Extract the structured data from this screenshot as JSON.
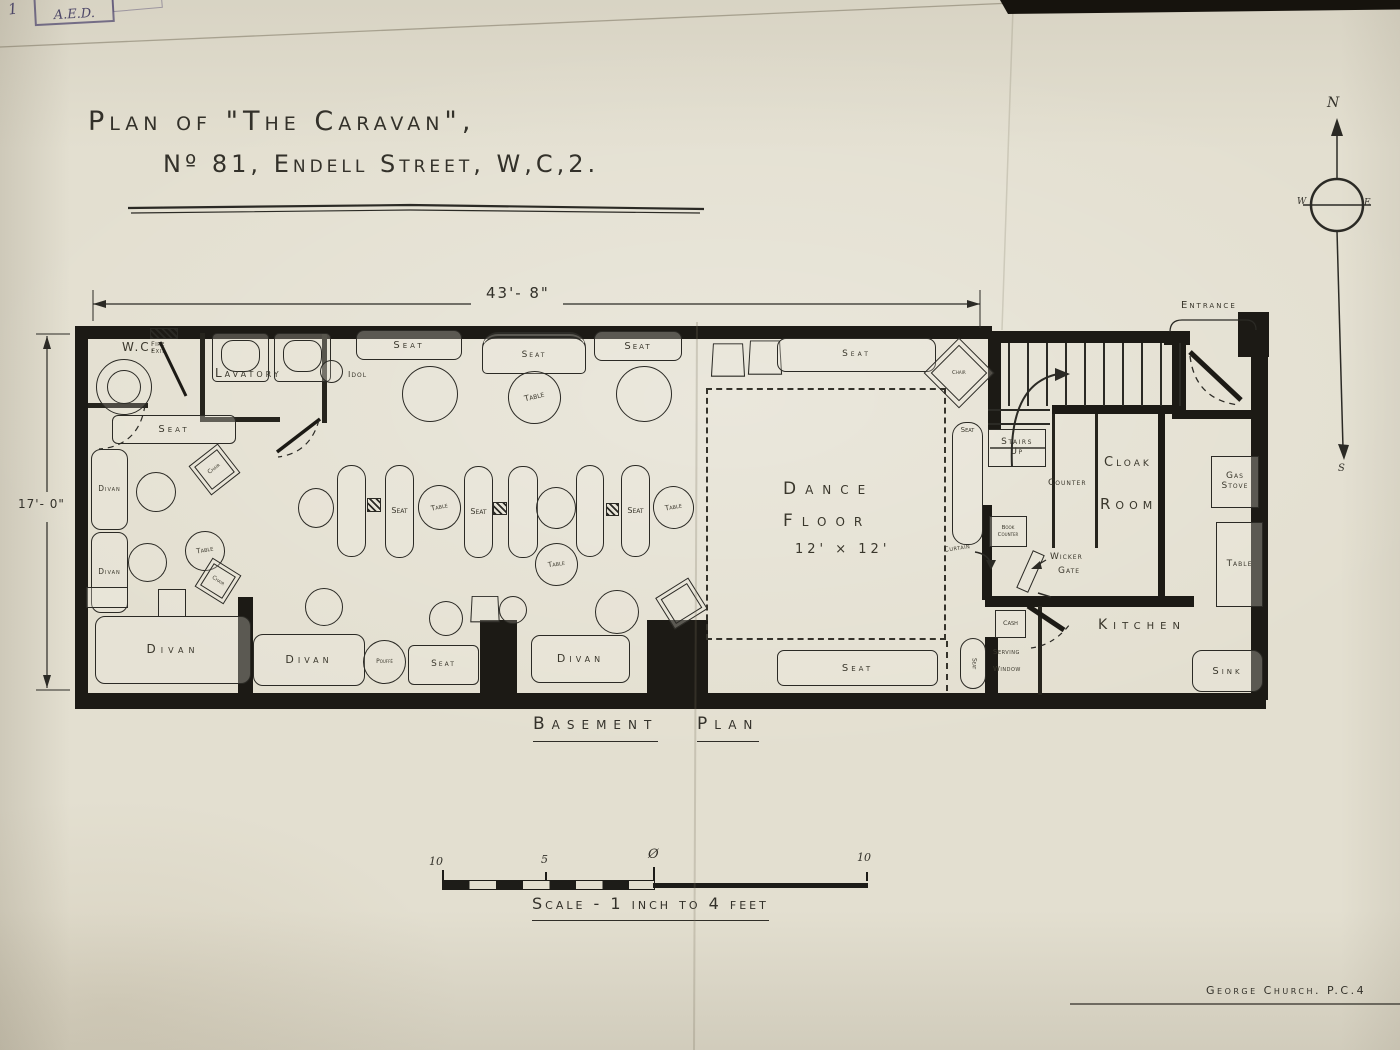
{
  "stamp": {
    "number": "1",
    "initials": "A.E.D."
  },
  "title": {
    "line1": "Plan of \"The Caravan\",",
    "line2": "Nº 81, Endell Street, W,C,2."
  },
  "compass": {
    "n": "N",
    "e": "E",
    "s": "S",
    "w": "W"
  },
  "dimensions": {
    "width": "43'- 8\"",
    "height": "17'- 0\""
  },
  "caption": {
    "word1": "Basement",
    "word2": "Plan"
  },
  "scale_bar": {
    "left_label": "10",
    "mid_label": "5",
    "zero_label": "Ø",
    "right_label": "10",
    "caption": "Scale - 1 inch to 4 feet"
  },
  "signature": "George Church. P.C.4",
  "plan": {
    "walls": [
      [
        75,
        326,
        917,
        13
      ],
      [
        988,
        331,
        200,
        12
      ],
      [
        75,
        326,
        13,
        380
      ],
      [
        75,
        693,
        1191,
        16
      ],
      [
        1251,
        340,
        17,
        360
      ],
      [
        1238,
        312,
        31,
        45
      ],
      [
        1164,
        331,
        26,
        14
      ],
      [
        988,
        338,
        13,
        92
      ],
      [
        1052,
        405,
        133,
        9
      ],
      [
        1172,
        331,
        14,
        88
      ],
      [
        1180,
        410,
        72,
        9
      ],
      [
        238,
        597,
        15,
        98
      ],
      [
        480,
        620,
        37,
        75
      ],
      [
        647,
        620,
        61,
        75
      ],
      [
        985,
        596,
        209,
        11
      ],
      [
        982,
        505,
        10,
        95
      ],
      [
        985,
        637,
        13,
        58
      ],
      [
        1158,
        413,
        7,
        186
      ]
    ],
    "partitions": [
      [
        200,
        333,
        5,
        88
      ],
      [
        200,
        417,
        80,
        5
      ],
      [
        322,
        333,
        5,
        90
      ],
      [
        1052,
        414,
        3,
        134
      ],
      [
        1095,
        414,
        3,
        134
      ],
      [
        88,
        403,
        60,
        5
      ],
      [
        1038,
        606,
        4,
        89
      ],
      [
        990,
        447,
        55,
        2
      ]
    ],
    "items": [
      {
        "name": "toilet",
        "t": "toilet",
        "x": 96,
        "y": 359,
        "w": 56,
        "h": 56
      },
      {
        "name": "wc-label",
        "t": "label",
        "x": 122,
        "y": 341,
        "fs": 12,
        "ls": 2,
        "lab": "W.C."
      },
      {
        "name": "fire-exit-hatch",
        "t": "hatch",
        "x": 150,
        "y": 328,
        "w": 28,
        "h": 11
      },
      {
        "name": "fire-exit-label",
        "t": "label",
        "x": 151,
        "y": 341,
        "fs": 6.5,
        "ls": 0.5,
        "lab": "Fire\nExit"
      },
      {
        "name": "basin",
        "t": "basin",
        "x": 212,
        "y": 333,
        "w": 57,
        "h": 49
      },
      {
        "name": "basin",
        "t": "basin",
        "x": 274,
        "y": 333,
        "w": 57,
        "h": 49
      },
      {
        "name": "lavatory-label",
        "t": "label",
        "x": 215,
        "y": 367,
        "fs": 12,
        "ls": 3,
        "lab": "Lavatory"
      },
      {
        "name": "idol-circle",
        "t": "circle",
        "x": 320,
        "y": 360,
        "w": 23,
        "h": 23
      },
      {
        "name": "idol-label",
        "t": "label",
        "x": 348,
        "y": 371,
        "fs": 8,
        "ls": 1,
        "lab": "Idol"
      },
      {
        "name": "seat",
        "t": "box",
        "x": 356,
        "y": 330,
        "w": 106,
        "h": 30,
        "r": 8,
        "lab": "Seat",
        "fs": 10,
        "ls": 3
      },
      {
        "name": "canopy-seat",
        "t": "canopy",
        "x": 482,
        "y": 332,
        "w": 104,
        "h": 42,
        "lab": "Seat",
        "fs": 9,
        "ls": 2
      },
      {
        "name": "seat",
        "t": "box",
        "x": 594,
        "y": 331,
        "w": 88,
        "h": 30,
        "r": 8,
        "lab": "Seat",
        "fs": 10,
        "ls": 2
      },
      {
        "name": "table",
        "t": "circle",
        "x": 402,
        "y": 366,
        "w": 56,
        "h": 56
      },
      {
        "name": "table",
        "t": "circle",
        "x": 508,
        "y": 371,
        "w": 53,
        "h": 53,
        "lab": "Table",
        "fs": 8,
        "rot": -14
      },
      {
        "name": "table",
        "t": "circle",
        "x": 616,
        "y": 366,
        "w": 56,
        "h": 56
      },
      {
        "name": "seat",
        "t": "box",
        "x": 112,
        "y": 415,
        "w": 124,
        "h": 29,
        "r": 6,
        "lab": "Seat",
        "fs": 10,
        "ls": 3
      },
      {
        "name": "divan",
        "t": "box",
        "x": 91,
        "y": 449,
        "w": 37,
        "h": 81,
        "r": 10,
        "lab": "Divan",
        "fs": 7.5,
        "ls": 1
      },
      {
        "name": "table",
        "t": "circle",
        "x": 136,
        "y": 472,
        "w": 40,
        "h": 40
      },
      {
        "name": "chair",
        "t": "box",
        "x": 196,
        "y": 451,
        "w": 37,
        "h": 37,
        "rot": -38,
        "dbl": true,
        "lab": "Chair",
        "fs": 6
      },
      {
        "name": "divan",
        "t": "box",
        "x": 91,
        "y": 532,
        "w": 37,
        "h": 81,
        "r": 10,
        "lab": "Divan",
        "fs": 7.5,
        "ls": 1
      },
      {
        "name": "table",
        "t": "circle",
        "x": 128,
        "y": 543,
        "w": 39,
        "h": 39
      },
      {
        "name": "table",
        "t": "circle",
        "x": 185,
        "y": 531,
        "w": 40,
        "h": 40,
        "lab": "Table",
        "fs": 7,
        "rot": -10
      },
      {
        "name": "chair",
        "t": "box",
        "x": 201,
        "y": 564,
        "w": 34,
        "h": 34,
        "rot": 32,
        "dbl": true,
        "lab": "Chair",
        "fs": 5.5
      },
      {
        "name": "seat-block",
        "t": "box",
        "x": 86,
        "y": 587,
        "w": 42,
        "h": 21
      },
      {
        "name": "stool",
        "t": "box",
        "x": 158,
        "y": 589,
        "w": 28,
        "h": 28
      },
      {
        "name": "divan",
        "t": "box",
        "x": 95,
        "y": 616,
        "w": 156,
        "h": 68,
        "r": 10,
        "lab": "Divan",
        "fs": 12,
        "ls": 5
      },
      {
        "name": "divan",
        "t": "box",
        "x": 253,
        "y": 634,
        "w": 112,
        "h": 52,
        "r": 10,
        "lab": "Divan",
        "fs": 11,
        "ls": 4
      },
      {
        "name": "pouffe",
        "t": "circle",
        "x": 363,
        "y": 640,
        "w": 43,
        "h": 44,
        "lab": "Pouffé",
        "fs": 6
      },
      {
        "name": "seat",
        "t": "box",
        "x": 408,
        "y": 645,
        "w": 71,
        "h": 40,
        "r": 6,
        "lab": "Seat",
        "fs": 9,
        "ls": 2
      },
      {
        "name": "table",
        "t": "circle",
        "x": 429,
        "y": 601,
        "w": 34,
        "h": 35
      },
      {
        "name": "stool",
        "t": "trap",
        "x": 471,
        "y": 595,
        "w": 28,
        "h": 27
      },
      {
        "name": "table",
        "t": "circle",
        "x": 499,
        "y": 596,
        "w": 28,
        "h": 28
      },
      {
        "name": "table",
        "t": "circle",
        "x": 595,
        "y": 590,
        "w": 44,
        "h": 44
      },
      {
        "name": "divan",
        "t": "box",
        "x": 531,
        "y": 635,
        "w": 99,
        "h": 48,
        "r": 9,
        "lab": "Divan",
        "fs": 11,
        "ls": 4
      },
      {
        "name": "chair",
        "t": "box",
        "x": 662,
        "y": 585,
        "w": 39,
        "h": 37,
        "rot": -32,
        "dbl": true
      },
      {
        "name": "table",
        "t": "circle",
        "x": 298,
        "y": 488,
        "w": 36,
        "h": 40
      },
      {
        "name": "bench",
        "t": "bench",
        "x": 337,
        "y": 465,
        "w": 29,
        "h": 92
      },
      {
        "name": "hatch-square",
        "t": "hatch",
        "x": 367,
        "y": 498,
        "w": 14,
        "h": 14
      },
      {
        "name": "bench",
        "t": "bench",
        "x": 385,
        "y": 465,
        "w": 29,
        "h": 93,
        "lab": "Seat",
        "fs": 8
      },
      {
        "name": "table",
        "t": "circle",
        "x": 418,
        "y": 485,
        "w": 43,
        "h": 45,
        "lab": "Table",
        "fs": 7,
        "rot": -12
      },
      {
        "name": "bench",
        "t": "bench",
        "x": 464,
        "y": 466,
        "w": 29,
        "h": 92,
        "lab": "Seat",
        "fs": 8
      },
      {
        "name": "hatch-square",
        "t": "hatch",
        "x": 493,
        "y": 502,
        "w": 14,
        "h": 13
      },
      {
        "name": "bench",
        "t": "bench",
        "x": 508,
        "y": 466,
        "w": 30,
        "h": 92
      },
      {
        "name": "table",
        "t": "circle",
        "x": 536,
        "y": 487,
        "w": 40,
        "h": 42
      },
      {
        "name": "bench",
        "t": "bench",
        "x": 576,
        "y": 465,
        "w": 28,
        "h": 92
      },
      {
        "name": "hatch-square",
        "t": "hatch",
        "x": 606,
        "y": 503,
        "w": 13,
        "h": 13
      },
      {
        "name": "bench",
        "t": "bench",
        "x": 621,
        "y": 465,
        "w": 29,
        "h": 92,
        "lab": "Seat",
        "fs": 8
      },
      {
        "name": "table",
        "t": "circle",
        "x": 653,
        "y": 486,
        "w": 41,
        "h": 43,
        "lab": "Table",
        "fs": 7,
        "rot": -10
      },
      {
        "name": "table",
        "t": "circle",
        "x": 535,
        "y": 543,
        "w": 43,
        "h": 43,
        "lab": "Table",
        "fs": 7,
        "rot": -8
      },
      {
        "name": "table",
        "t": "circle",
        "x": 305,
        "y": 588,
        "w": 38,
        "h": 38
      },
      {
        "name": "stool",
        "t": "trap",
        "x": 712,
        "y": 342,
        "w": 32,
        "h": 34
      },
      {
        "name": "stool",
        "t": "trap",
        "x": 749,
        "y": 339,
        "w": 32,
        "h": 35
      },
      {
        "name": "seat",
        "t": "box",
        "x": 777,
        "y": 338,
        "w": 159,
        "h": 34,
        "r": 9,
        "lab": "Seat",
        "fs": 9,
        "ls": 3
      },
      {
        "name": "chair",
        "t": "diamond",
        "x": 934,
        "y": 348,
        "w": 50,
        "h": 50,
        "lab": "Chair",
        "fs": 5.5
      },
      {
        "name": "dance-floor",
        "t": "dashed",
        "x": 706,
        "y": 388,
        "w": 240,
        "h": 252
      },
      {
        "name": "dance-floor-label",
        "t": "label",
        "x": 783,
        "y": 480,
        "fs": 17,
        "ls": 9,
        "lab": "Dance"
      },
      {
        "name": "dance-floor-label",
        "t": "label",
        "x": 783,
        "y": 512,
        "fs": 17,
        "ls": 9,
        "lab": "Floor"
      },
      {
        "name": "dance-floor-size",
        "t": "label",
        "x": 795,
        "y": 543,
        "fs": 13,
        "ls": 4,
        "lab": "12' × 12'"
      },
      {
        "name": "bench",
        "t": "bench",
        "x": 952,
        "y": 422,
        "w": 31,
        "h": 123,
        "lab": "Seat",
        "fs": 7,
        "labtop": true
      },
      {
        "name": "curtain-label",
        "t": "label",
        "x": 944,
        "y": 545,
        "fs": 7,
        "ls": 0.5,
        "lab": "Curtain",
        "rot": -8
      },
      {
        "name": "curtain-line",
        "t": "dashv",
        "x": 946,
        "y": 641,
        "h": 50
      },
      {
        "name": "seat",
        "t": "box",
        "x": 777,
        "y": 650,
        "w": 161,
        "h": 36,
        "r": 7,
        "lab": "Seat",
        "fs": 10,
        "ls": 3
      },
      {
        "name": "seat-small",
        "t": "bench",
        "x": 960,
        "y": 638,
        "w": 26,
        "h": 51,
        "lab": "Seat",
        "fs": 6,
        "vert": true
      },
      {
        "name": "entrance-label",
        "t": "label",
        "x": 1181,
        "y": 300,
        "fs": 10,
        "ls": 2,
        "lab": "Entrance"
      },
      {
        "name": "stairs-treads",
        "t": "stairs-v",
        "x": 1008,
        "y": 343,
        "w": 174,
        "h": 63
      },
      {
        "name": "stairs-treads-lower",
        "t": "stairs-h",
        "x": 988,
        "y": 409,
        "w": 62,
        "h": 22
      },
      {
        "name": "stairs-up-box",
        "t": "box",
        "x": 988,
        "y": 429,
        "w": 58,
        "h": 38,
        "lab": "Stairs\nUp",
        "fs": 9,
        "ls": 1.5
      },
      {
        "name": "counter-label",
        "t": "label",
        "x": 1048,
        "y": 479,
        "fs": 9,
        "ls": 1,
        "lab": "Counter"
      },
      {
        "name": "cloak-label",
        "t": "label",
        "x": 1104,
        "y": 456,
        "fs": 13,
        "ls": 3,
        "lab": "Cloak"
      },
      {
        "name": "room-label",
        "t": "label",
        "x": 1100,
        "y": 496,
        "fs": 15,
        "ls": 5,
        "lab": "Room"
      },
      {
        "name": "book-counter",
        "t": "box",
        "x": 989,
        "y": 516,
        "w": 38,
        "h": 31,
        "lab": "Book\nCounter",
        "fs": 5.5
      },
      {
        "name": "wicker-gate-label",
        "t": "label",
        "x": 1050,
        "y": 553,
        "fs": 9,
        "ls": 1,
        "lab": "Wicker"
      },
      {
        "name": "wicker-gate-label",
        "t": "label",
        "x": 1058,
        "y": 567,
        "fs": 9,
        "ls": 1,
        "lab": "Gate"
      },
      {
        "name": "wicker-gate-leaf",
        "t": "box",
        "x": 1024,
        "y": 551,
        "w": 13,
        "h": 41,
        "rot": 24
      },
      {
        "name": "kitchen-label",
        "t": "label",
        "x": 1098,
        "y": 618,
        "fs": 14,
        "ls": 6,
        "lab": "Kitchen"
      },
      {
        "name": "cash-box",
        "t": "box",
        "x": 995,
        "y": 610,
        "w": 31,
        "h": 28,
        "lab": "Cash",
        "fs": 6.5
      },
      {
        "name": "serving-window-label",
        "t": "label",
        "x": 993,
        "y": 649,
        "fs": 7,
        "ls": 0.5,
        "lab": "Serving"
      },
      {
        "name": "serving-window-label",
        "t": "label",
        "x": 993,
        "y": 666,
        "fs": 7,
        "ls": 0.5,
        "lab": "Window"
      },
      {
        "name": "gas-stove",
        "t": "box",
        "x": 1211,
        "y": 456,
        "w": 48,
        "h": 52,
        "lab": "Gas\nStove",
        "fs": 9,
        "ls": 1
      },
      {
        "name": "kitchen-table",
        "t": "box",
        "x": 1216,
        "y": 522,
        "w": 47,
        "h": 85,
        "lab": "Table",
        "fs": 9,
        "ls": 1
      },
      {
        "name": "sink",
        "t": "box",
        "x": 1192,
        "y": 650,
        "w": 71,
        "h": 42,
        "r": 10,
        "lab": "Sink",
        "fs": 10,
        "ls": 3
      }
    ]
  }
}
